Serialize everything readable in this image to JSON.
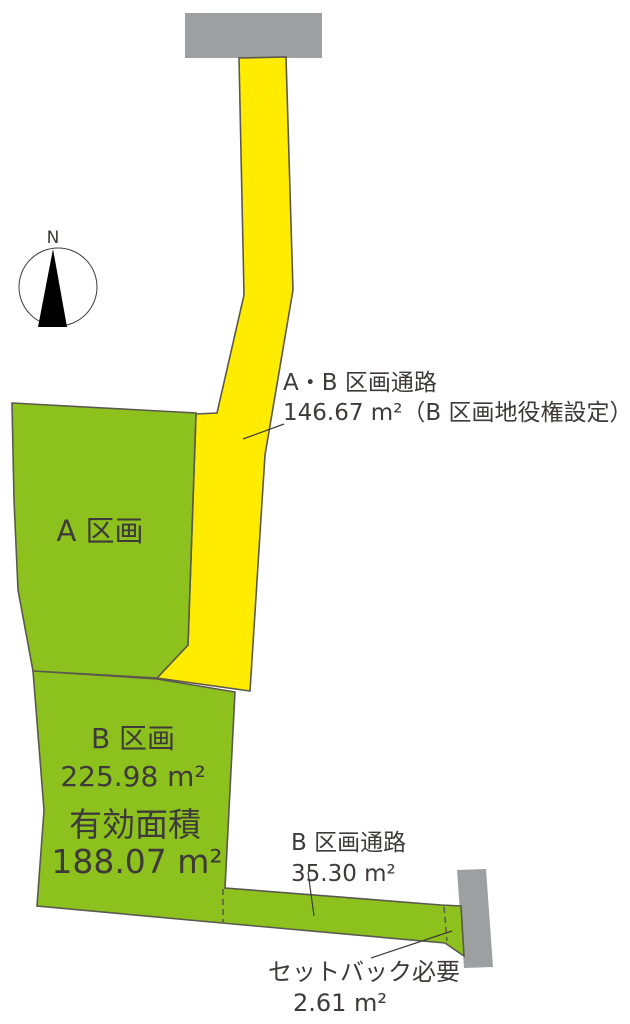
{
  "compass": {
    "north": "N"
  },
  "parcels": {
    "a": {
      "name": "A 区画"
    },
    "b": {
      "name": "B 区画",
      "area": "225.98 m²",
      "effective_label": "有効面積",
      "effective_area": "188.07 m²"
    }
  },
  "passages": {
    "ab": {
      "name": "A・B 区画通路",
      "detail": "146.67 m²（B 区画地役権設定）"
    },
    "b": {
      "name": "B 区画通路",
      "area": "35.30 m²"
    }
  },
  "setback": {
    "name": "セットバック必要",
    "area": "2.61 m²"
  },
  "colors": {
    "parcel_green": "#8dc21e",
    "passage_yellow": "#ffec00",
    "road_gray": "#9e9fa0",
    "outline": "#5b584e",
    "text": "#3e3a39",
    "needle_black": "#000000"
  }
}
